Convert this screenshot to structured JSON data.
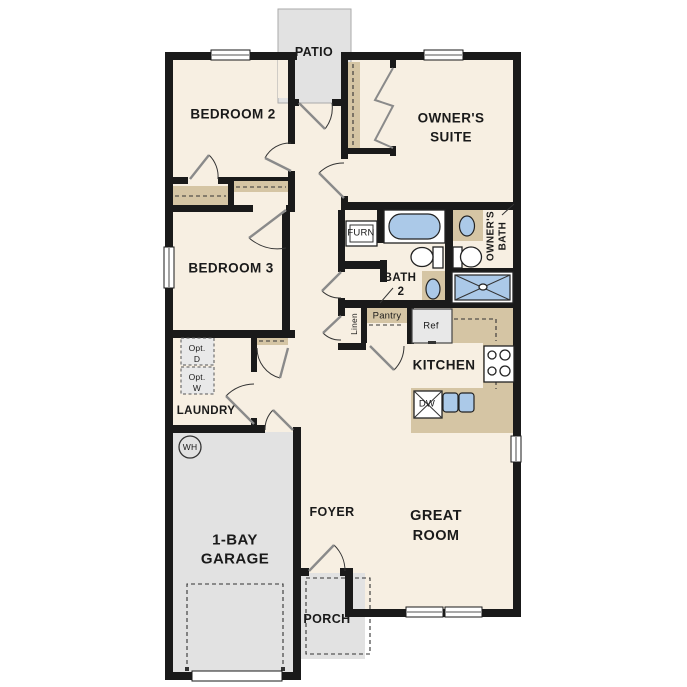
{
  "plan_type": "single-story floor plan",
  "rooms": {
    "patio": {
      "label": "PATIO"
    },
    "bedroom2": {
      "label": "BEDROOM 2"
    },
    "owners_suite": {
      "line1": "OWNER'S",
      "line2": "SUITE"
    },
    "bedroom3": {
      "label": "BEDROOM 3"
    },
    "owners_bath": {
      "line1": "OWNER'S",
      "line2": "BATH"
    },
    "bath2": {
      "line1": "BATH",
      "line2": "2"
    },
    "kitchen": {
      "label": "KITCHEN"
    },
    "laundry": {
      "label": "LAUNDRY"
    },
    "garage": {
      "line1": "1-BAY",
      "line2": "GARAGE"
    },
    "foyer": {
      "label": "FOYER"
    },
    "great_room": {
      "line1": "GREAT",
      "line2": "ROOM"
    },
    "porch": {
      "label": "PORCH"
    }
  },
  "fixtures": {
    "furnace": {
      "label": "FURN"
    },
    "linen": {
      "label": "Linen"
    },
    "pantry": {
      "label": "Pantry"
    },
    "refrigerator": {
      "label": "Ref"
    },
    "dishwasher": {
      "label": "DW"
    },
    "water_heater": {
      "label": "WH"
    },
    "optional_dryer": {
      "line1": "Opt.",
      "line2": "D"
    },
    "optional_washer": {
      "line1": "Opt.",
      "line2": "W"
    }
  },
  "colors": {
    "background": "#ffffff",
    "floor": "#f7efe2",
    "wall": "#1a1a1a",
    "patio_floor": "#e4e4e4",
    "garage_floor": "#e2e2e2",
    "porch_floor": "#e2e2e2",
    "counter_tan": "#d5c5a4",
    "fixture_blue": "#abc9e8",
    "appliance_gray": "#e8e8e8",
    "text": "#1a1a1a"
  }
}
